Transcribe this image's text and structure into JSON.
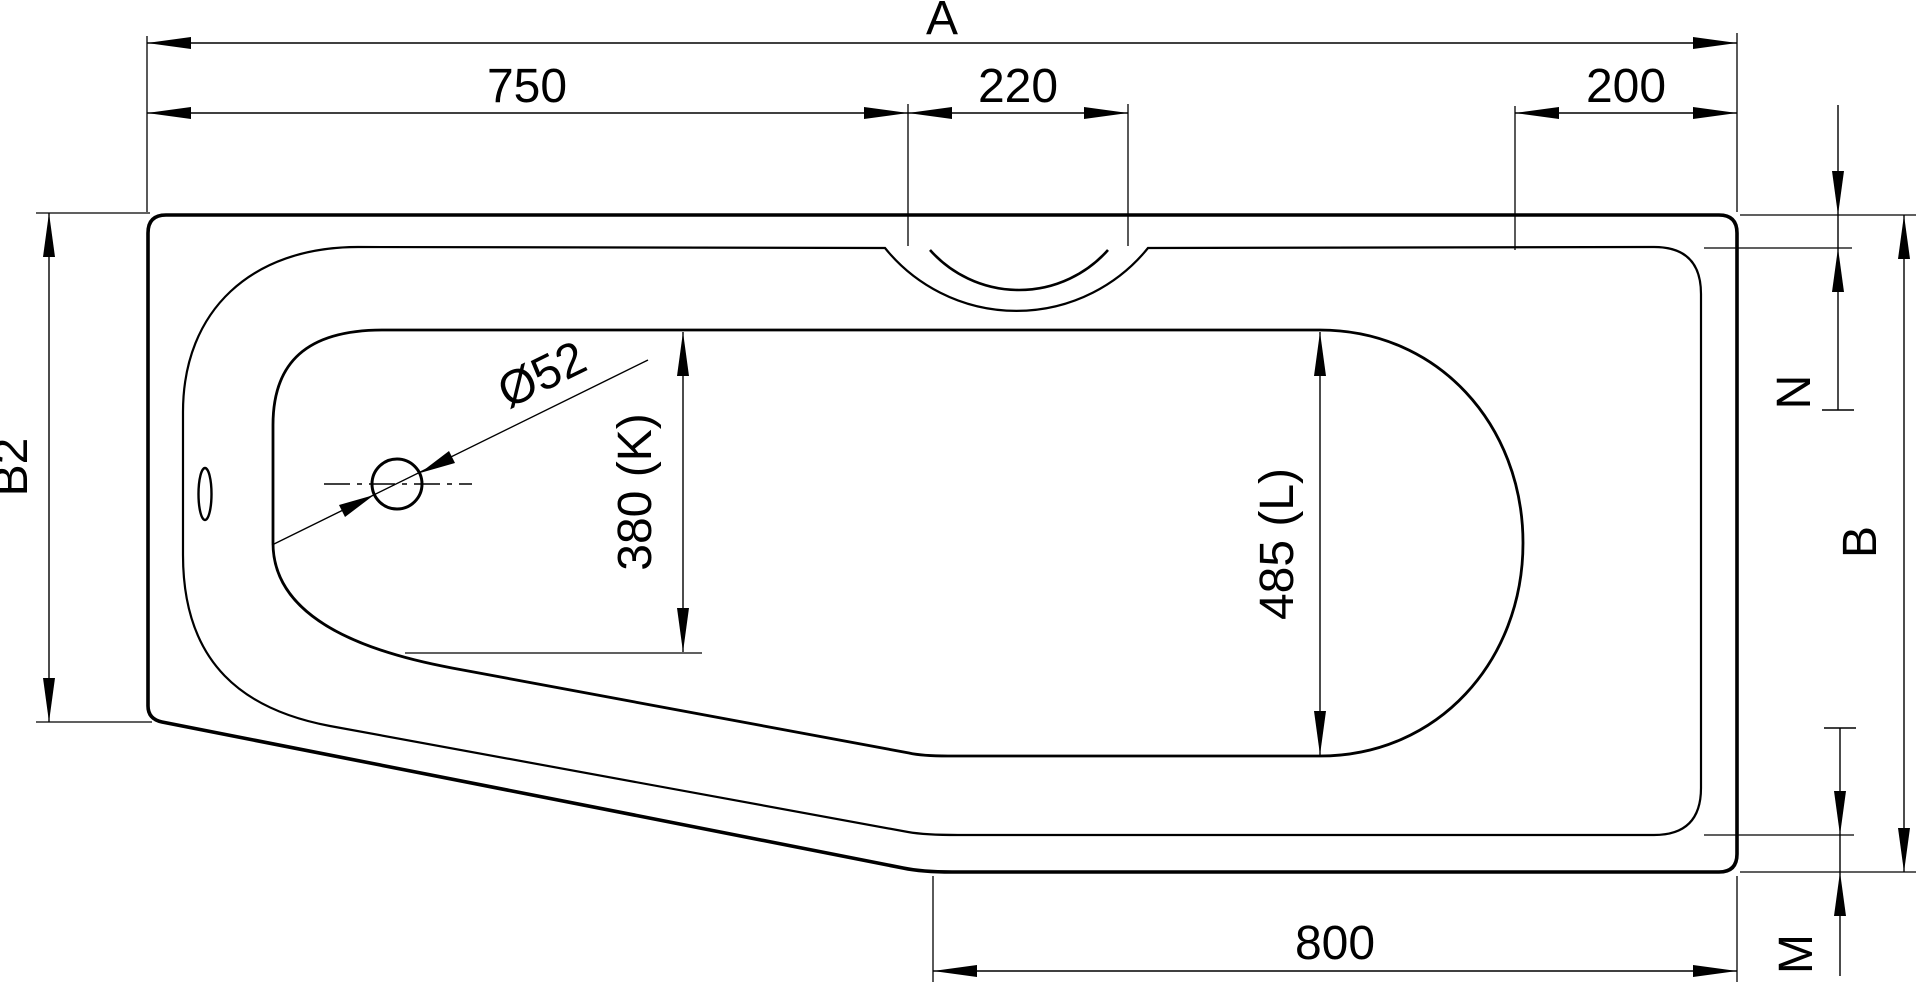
{
  "drawing": {
    "description": "bathtub top view dimensional drawing",
    "background_color": "#ffffff",
    "line_color": "#000000"
  },
  "dimensions": {
    "overall_length": {
      "label": "A",
      "axis": "horizontal"
    },
    "segment_left": {
      "label": "750",
      "value": 750,
      "axis": "horizontal"
    },
    "grip_width": {
      "label": "220",
      "value": 220,
      "axis": "horizontal"
    },
    "segment_right": {
      "label": "200",
      "value": 200,
      "axis": "horizontal"
    },
    "width_left_end": {
      "label": "B2",
      "axis": "vertical"
    },
    "rim_gap_top": {
      "label": "N",
      "axis": "vertical"
    },
    "width_right_end": {
      "label": "B",
      "axis": "vertical"
    },
    "rim_gap_bottom": {
      "label": "M",
      "axis": "vertical"
    },
    "bottom_edge_length": {
      "label": "800",
      "value": 800,
      "axis": "horizontal"
    },
    "inner_width_at_drain": {
      "label": "380 (K)",
      "value": 380,
      "axis": "vertical"
    },
    "inner_width_right": {
      "label": "485 (L)",
      "value": 485,
      "axis": "vertical"
    },
    "drain_diameter": {
      "label": "Ø52",
      "value": 52
    }
  }
}
